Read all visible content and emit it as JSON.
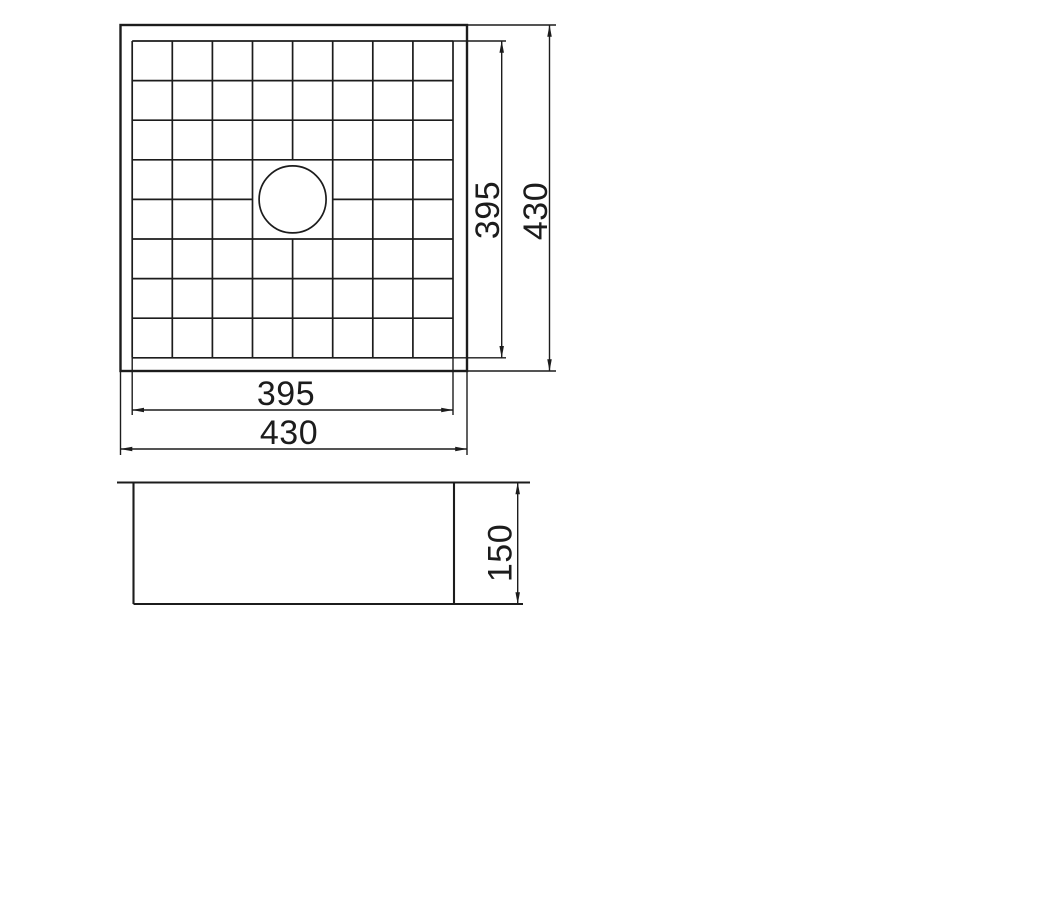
{
  "drawing": {
    "background": "#ffffff",
    "line_color": "#1c1c1c",
    "top_view": {
      "grid_rows": 8,
      "grid_cols": 8,
      "drain": "circular-drain-hole",
      "dim_inner_width": "395",
      "dim_outer_width": "430",
      "dim_inner_height": "395",
      "dim_outer_height": "430"
    },
    "side_view": {
      "dim_height": "150"
    }
  }
}
